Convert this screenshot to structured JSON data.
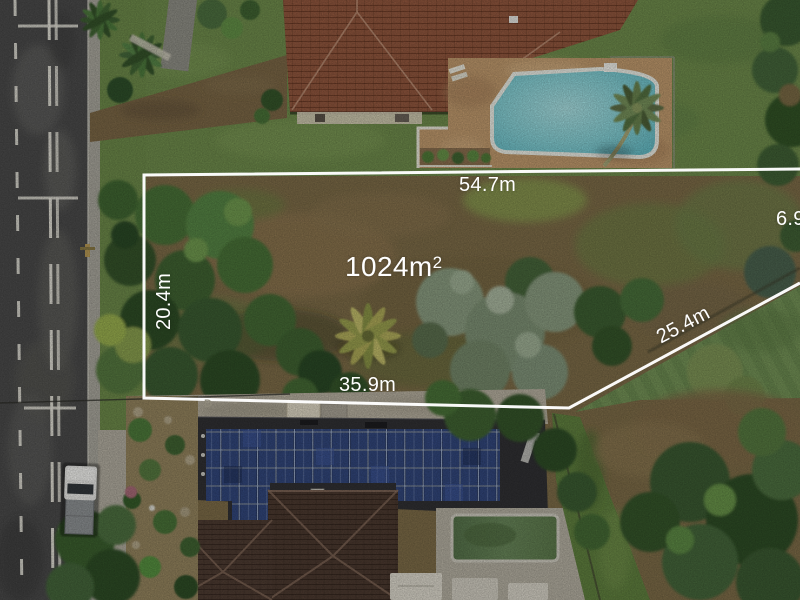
{
  "overlay": {
    "area": {
      "value": "1024m",
      "sup": "2"
    },
    "dimensions": {
      "top": "54.7m",
      "right": "6.9m",
      "diagonal": "25.4m",
      "left": "20.4m",
      "bottom": "35.9m"
    },
    "line_color": "#ffffff",
    "label_color": "#ffffff"
  },
  "ground_marking": {
    "text": "D"
  },
  "palette": {
    "road_asphalt": "#4b4b4b",
    "lawn_green": "#6f8c4c",
    "lot_dirt": "#7d6c48",
    "tree_dark_green": "#2f4d28",
    "pool_water_teal": "#7cc9cf",
    "roof_terracotta": "#91573e",
    "roof_dark_grey": "#313134",
    "solar_panel_blue": "#2b3c6a",
    "paving_tan": "#c09a6d"
  }
}
